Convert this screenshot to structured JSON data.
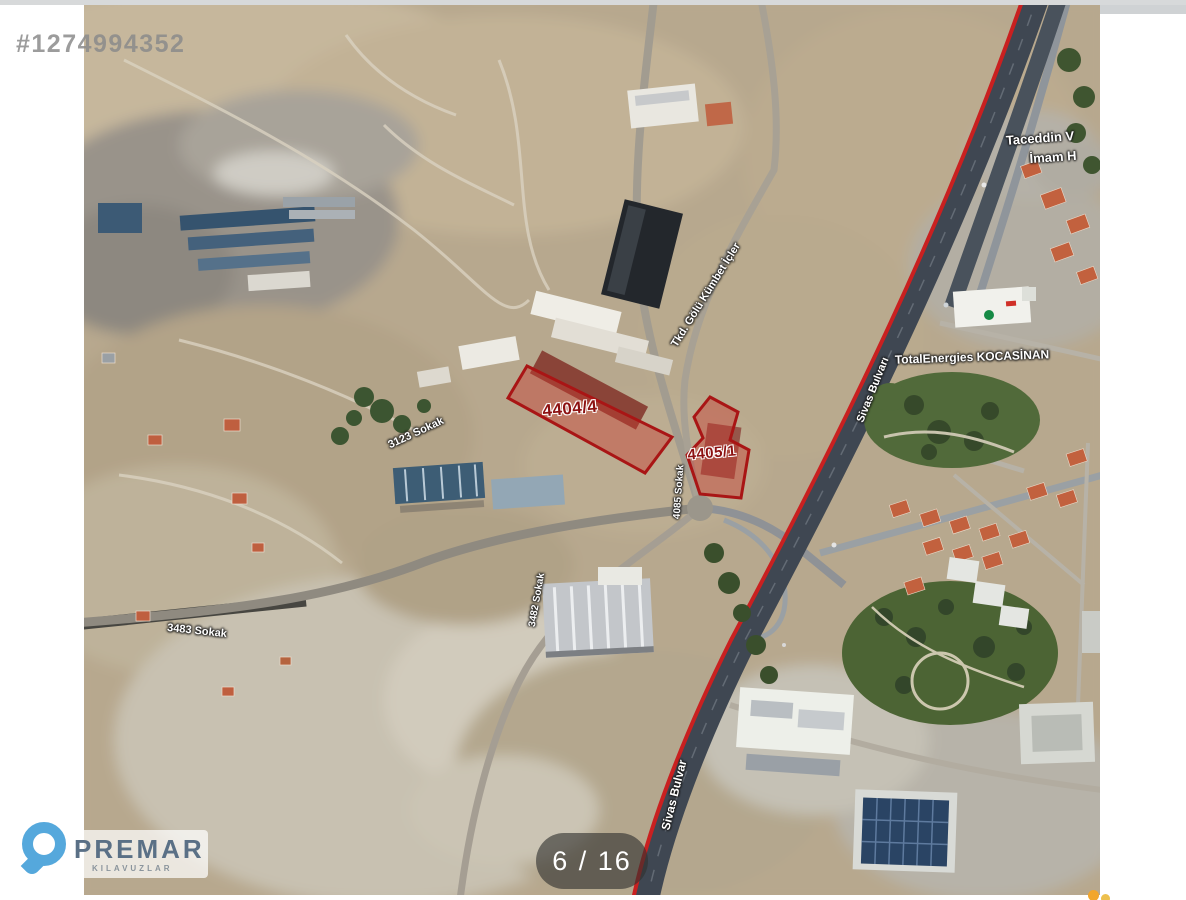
{
  "watermark": {
    "id_text": "#1274994352"
  },
  "pagination": {
    "current": "6 / 16"
  },
  "logo": {
    "brand": "PREMAR",
    "subtitle": "KILAVUZLAR"
  },
  "map": {
    "parcels": [
      {
        "label": "4404/4"
      },
      {
        "label": "4405/1"
      }
    ],
    "street_labels": [
      {
        "label": "Tkd. Gölü Kümbet İçler"
      },
      {
        "label": "Sivas Bulvarı"
      },
      {
        "label": "Sivas Bulvar"
      },
      {
        "label": "3483 Sokak"
      },
      {
        "label": "3123 Sokak"
      },
      {
        "label": "3482 Sokak"
      },
      {
        "label": "4085 Sokak"
      }
    ],
    "poi_labels": [
      {
        "label": "Taceddin V"
      },
      {
        "label": "İmam H"
      },
      {
        "label": "TotalEnergies KOCASİNAN"
      }
    ],
    "colors": {
      "parcel_outline": "#a91515",
      "parcel_fill": "rgba(200,55,45,0.42)",
      "route_line": "#c92020",
      "highway": "#3f4752"
    }
  }
}
